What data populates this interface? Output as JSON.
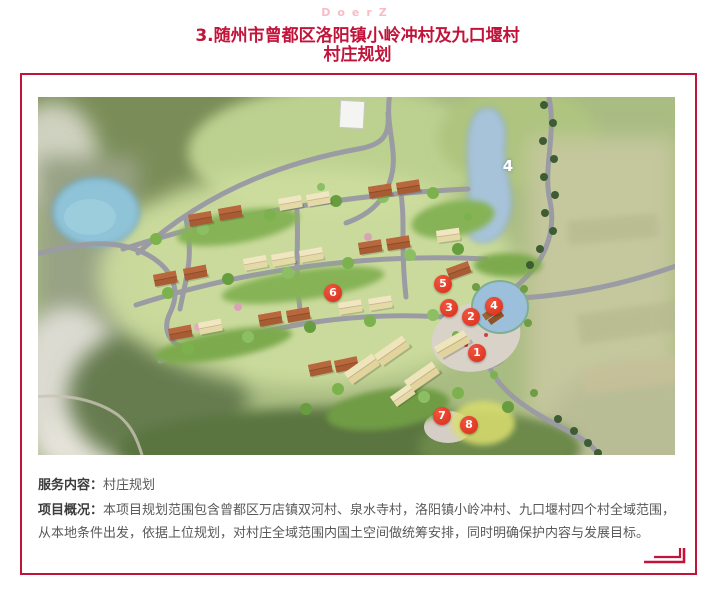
{
  "watermark": "DoerZ",
  "title": {
    "line1": "3.随州市曾都区洛阳镇小岭冲村及九口堰村",
    "line2": "村庄规划"
  },
  "map": {
    "lake_label": "4",
    "markers": [
      {
        "n": "1",
        "x": 439,
        "y": 256
      },
      {
        "n": "2",
        "x": 433,
        "y": 220
      },
      {
        "n": "3",
        "x": 411,
        "y": 211
      },
      {
        "n": "4",
        "x": 456,
        "y": 209
      },
      {
        "n": "5",
        "x": 405,
        "y": 187
      },
      {
        "n": "6",
        "x": 295,
        "y": 196
      },
      {
        "n": "7",
        "x": 404,
        "y": 319
      },
      {
        "n": "8",
        "x": 431,
        "y": 328
      }
    ]
  },
  "info": {
    "service_label": "服务内容：",
    "service_value": "村庄规划",
    "overview_label": "项目概况：",
    "overview_value": "本项目规划范围包含曾都区万店镇双河村、泉水寺村，洛阳镇小岭冲村、九口堰村四个村全域范围，从本地条件出发，依据上位规划，对村庄全域范围内国土空间做统筹安排，同时明确保护内容与发展目标。"
  },
  "colors": {
    "accent": "#c2143a",
    "marker_red": "#d92d18",
    "watermark_pink": "#f7bcc8",
    "body_text": "#595959",
    "label_text": "#3c3c3c"
  }
}
